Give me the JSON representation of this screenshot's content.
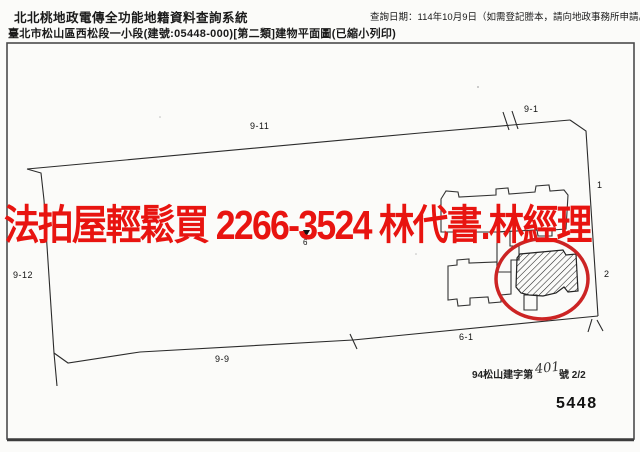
{
  "header": {
    "system_title": "北北桃地政電傳全功能地籍資料查詢系統",
    "query_date": "查詢日期：114年10月9日（如需登記謄本，請向地政事務所申請。）",
    "document_title": "臺北市松山區西松段一小段(建號:05448-000)[第二類]建物平面圖(已縮小列印)"
  },
  "watermark": {
    "text": "法拍屋輕鬆買 2266-3524 林代書.林經理",
    "color": "#e81410"
  },
  "diagram": {
    "annotation_color": "#cc2424",
    "line_color": "#2b2b2b",
    "labels": [
      {
        "text": "9-11"
      },
      {
        "text": "9-1"
      },
      {
        "text": "9-12"
      },
      {
        "text": "9-9"
      },
      {
        "text": "6-1"
      },
      {
        "text": "1"
      },
      {
        "text": "2"
      },
      {
        "text": "6"
      }
    ]
  },
  "footer": {
    "permit_prefix": "94松山建字第",
    "permit_number": "401",
    "permit_suffix": "號 2/2",
    "building_id": "5448"
  }
}
